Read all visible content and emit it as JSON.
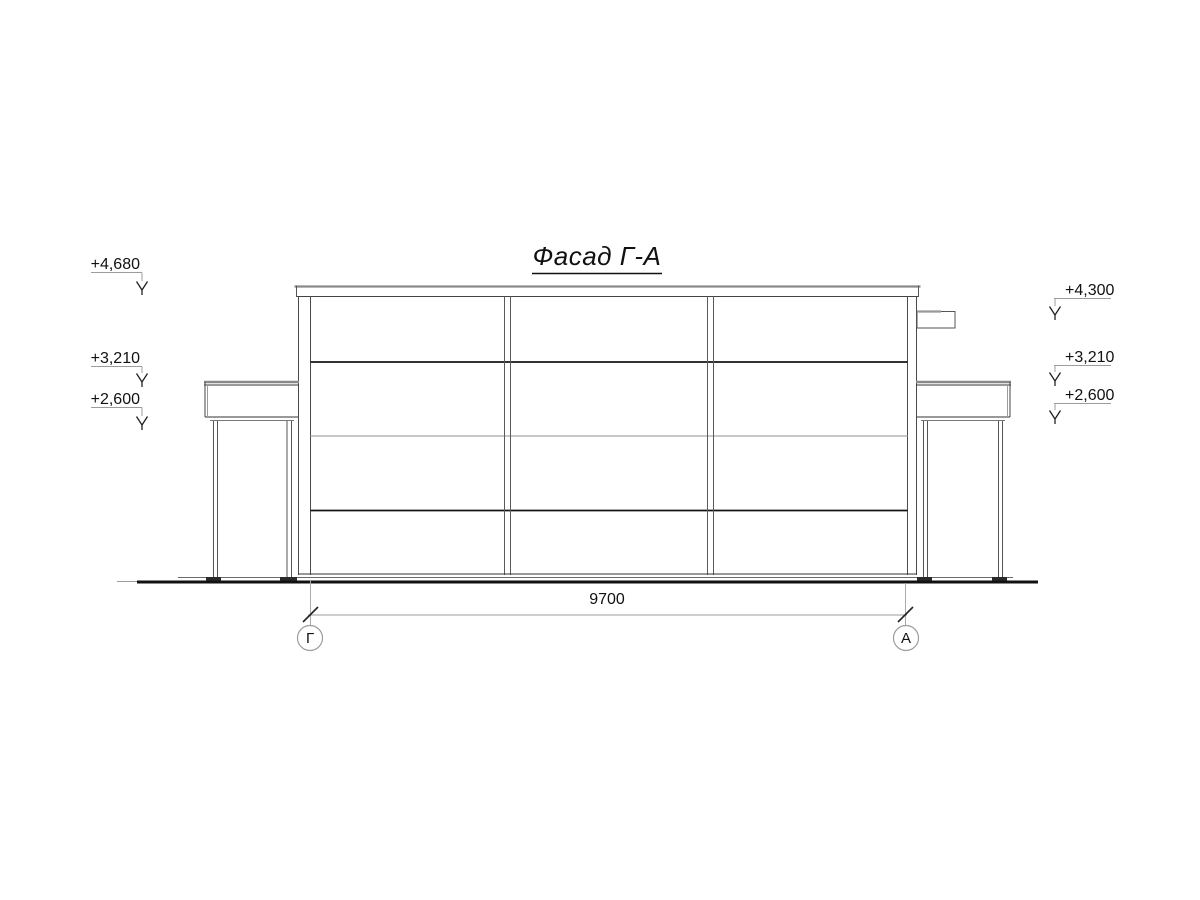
{
  "drawing": {
    "title": "Фасад Г-А",
    "elevations_left": [
      {
        "label": "+4,680"
      },
      {
        "label": "+3,210"
      },
      {
        "label": "+2,600"
      }
    ],
    "elevations_right": [
      {
        "label": "+4,300"
      },
      {
        "label": "+3,210"
      },
      {
        "label": "+2,600"
      }
    ],
    "dimension": {
      "value": "9700"
    },
    "axes": {
      "left": "Г",
      "right": "А"
    },
    "colors": {
      "background": "#ffffff",
      "line_dark": "#111111",
      "line_medium": "#555555",
      "line_light": "#9c9c9c"
    }
  }
}
